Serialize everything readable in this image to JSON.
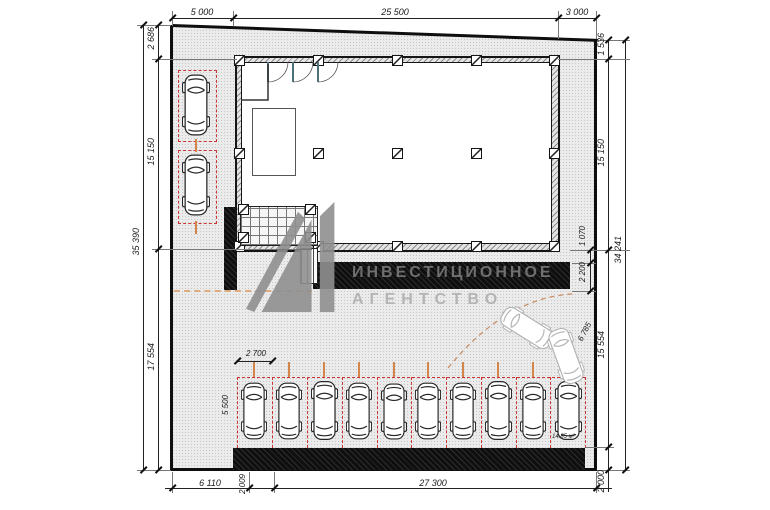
{
  "watermark": {
    "line1": "ИНВЕСТИЦИОННОЕ",
    "line2": "АГЕНТСТВО"
  },
  "dims": {
    "top": [
      "5 000",
      "25 500",
      "3 000"
    ],
    "left": [
      "2 686",
      "15 150",
      "17 554"
    ],
    "left_total": "35 390",
    "right": [
      "1 536",
      "15 150",
      "15 554",
      "2 000"
    ],
    "right_total": "34 241",
    "wall_offset": "1 070",
    "wall_height": "2 200",
    "bottom": [
      "6 110",
      "2 009",
      "27 300"
    ],
    "stall_width": "2 700",
    "stall_depth": "5 500",
    "stall_area": "14.85 м²",
    "turning_path": "6 785"
  },
  "colors": {
    "parking_divider": "#cc3434",
    "orange_mark": "#d4854a",
    "wall_black": "#0f0f0f",
    "watermark_gray": "#8f8f8f"
  }
}
